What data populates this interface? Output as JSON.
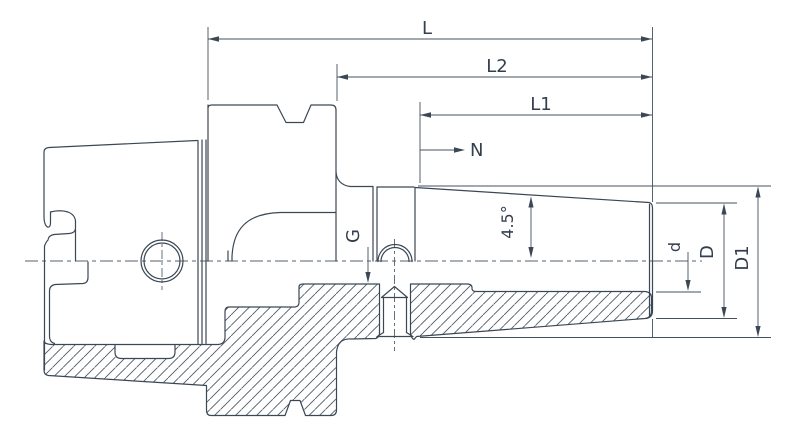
{
  "drawing": {
    "labels": {
      "overall_length": "L",
      "length_l2": "L2",
      "length_l1": "L1",
      "neck_ref": "N",
      "thread": "G",
      "taper_angle": "4.5°",
      "bore_diameter": "d",
      "nose_diameter": "D",
      "body_diameter": "D1"
    },
    "colors": {
      "line": "#3b4754",
      "text": "#333f4d",
      "hatch": "#4a5764",
      "background": "#ffffff"
    }
  }
}
